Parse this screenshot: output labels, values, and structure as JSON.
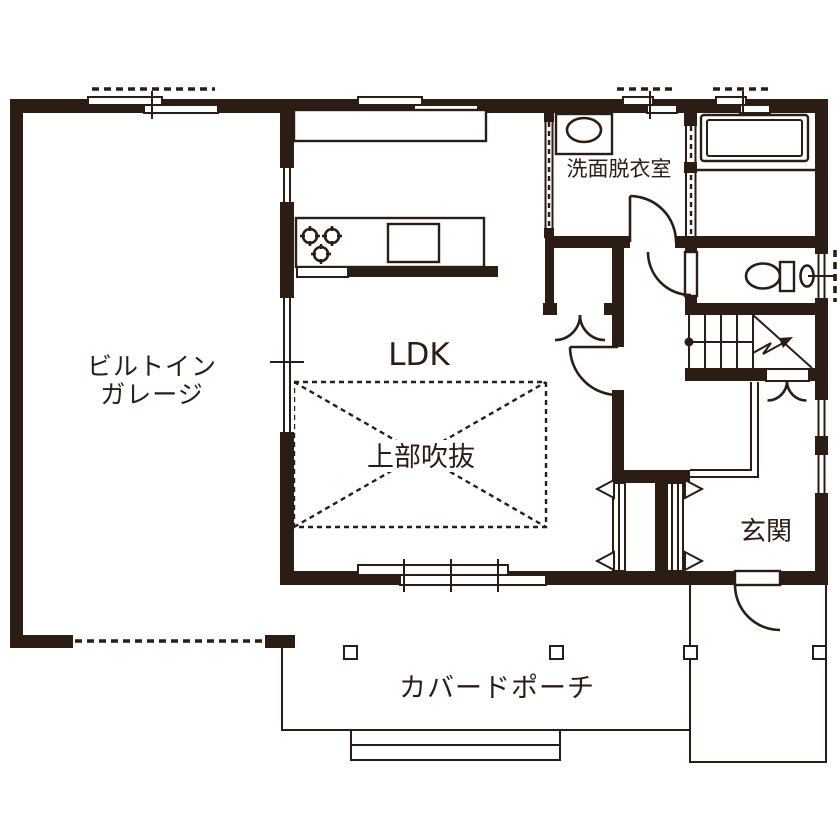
{
  "plan": {
    "colors": {
      "wall": "#2b1c14",
      "background": "#ffffff"
    },
    "rooms": {
      "garage": {
        "line1": "ビルトイン",
        "line2": "ガレージ"
      },
      "ldk": {
        "label": "LDK"
      },
      "void": {
        "label": "上部吹抜"
      },
      "washroom": {
        "label": "洗面脱衣室"
      },
      "entrance": {
        "label": "玄関"
      },
      "porch": {
        "label": "カバードポーチ"
      }
    },
    "fixtures": {
      "bathtub": "bathtub",
      "toilet": "toilet",
      "hand_basin": "hand-wash-basin",
      "washbasin": "vanity-basin",
      "stove": "gas-stove-3-burners",
      "kitchen_sink": "kitchen-sink",
      "stairs": "staircase-up-arrow",
      "garage_door": "garage-opening-dashed",
      "porch_steps": "porch-steps",
      "porch_posts": "porch-posts"
    }
  }
}
